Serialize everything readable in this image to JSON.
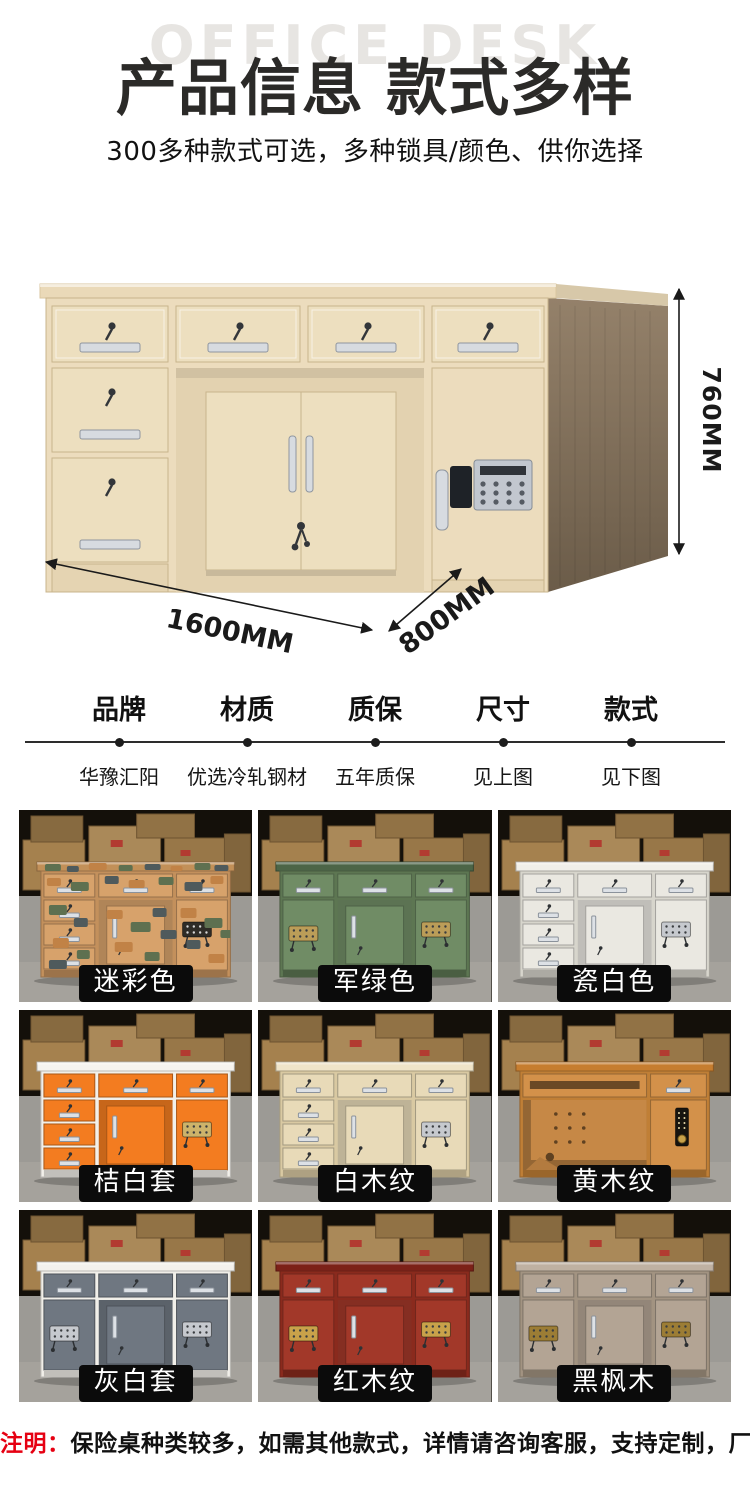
{
  "header": {
    "watermark": "OFFICE DESK",
    "title": "产品信息 款式多样",
    "subtitle": "300多种款式可选，多种锁具/颜色、供你选择"
  },
  "hero": {
    "dims": {
      "height": "760MM",
      "width": "1600MM",
      "depth": "800MM"
    },
    "colors": {
      "body": "#ecdcbd",
      "drawer": "#eddfbf",
      "trim": "#c8b48c",
      "recess": "#e3d2b0",
      "slab": "#ead9b8",
      "slab_edge": "#d9c69f",
      "side_top": "#94816a",
      "side_bottom": "#6b5c49",
      "handle": "#d7dbe0",
      "handle_edge": "#8f969f",
      "keypad": "#c2c7cf",
      "keypad_edge": "#868d96",
      "plinth": "#e5d4b2",
      "key": "#33363a"
    }
  },
  "specs": [
    {
      "label": "品牌",
      "value": "华豫汇阳"
    },
    {
      "label": "材质",
      "value": "优选冷轧钢材"
    },
    {
      "label": "质保",
      "value": "五年质保"
    },
    {
      "label": "尺寸",
      "value": "见上图"
    },
    {
      "label": "款式",
      "value": "见下图"
    }
  ],
  "photo_scene": {
    "backdrop": "#14100a",
    "floor": "#9c9a95",
    "floor_light": "#a5a29c",
    "box": "#a5814e",
    "box_edge": "#6d5330",
    "box_mark": "#b23b31"
  },
  "styles_grid": [
    {
      "label": "迷彩色",
      "variant": "camo",
      "left": "drawers",
      "frame": "#c3905c",
      "panel": "#d7a26b",
      "top": "#c29058",
      "lock": "#2f2c27",
      "patches": [
        "#5e7050",
        "#4f5a5c",
        "#c18246"
      ]
    },
    {
      "label": "军绿色",
      "variant": "standard",
      "left": "door",
      "frame": "#5d7652",
      "panel": "#708c65",
      "top": "#4c6547",
      "lock": "#bb9d58"
    },
    {
      "label": "瓷白色",
      "variant": "standard",
      "left": "drawers",
      "frame": "#d7d5cc",
      "panel": "#eae8e1",
      "top": "#f1efe9",
      "lock": "#c6c9ce"
    },
    {
      "label": "桔白套",
      "variant": "standard",
      "left": "drawers",
      "frame": "#f2f0ea",
      "panel": "#f37c20",
      "top": "#f6f4ef",
      "lock": "#cdb36a"
    },
    {
      "label": "白木纹",
      "variant": "standard",
      "left": "drawers",
      "frame": "#d9c9a2",
      "panel": "#e8dab8",
      "top": "#efe4c8",
      "lock": "#c6c9ce"
    },
    {
      "label": "黄木纹",
      "variant": "open",
      "left": "open",
      "frame": "#c07f36",
      "panel": "#d3914a",
      "top": "#c67d2f",
      "lock": "#17140f"
    },
    {
      "label": "灰白套",
      "variant": "standard",
      "left": "door",
      "frame": "#f1efe9",
      "panel": "#6f7781",
      "top": "#f3f1ec",
      "lock": "#c6c9ce"
    },
    {
      "label": "红木纹",
      "variant": "standard",
      "left": "door",
      "frame": "#8a2a1d",
      "panel": "#a23829",
      "top": "#7c2118",
      "lock": "#c9a24a"
    },
    {
      "label": "黑枫木",
      "variant": "standard",
      "left": "door",
      "frame": "#a29381",
      "panel": "#b3a494",
      "top": "#bfb1a2",
      "lock": "#9c7d35"
    }
  ],
  "footnote": {
    "prefix": "注明：",
    "text": "保险桌种类较多，如需其他款式，详情请咨询客服，支持定制，厂家直销"
  }
}
